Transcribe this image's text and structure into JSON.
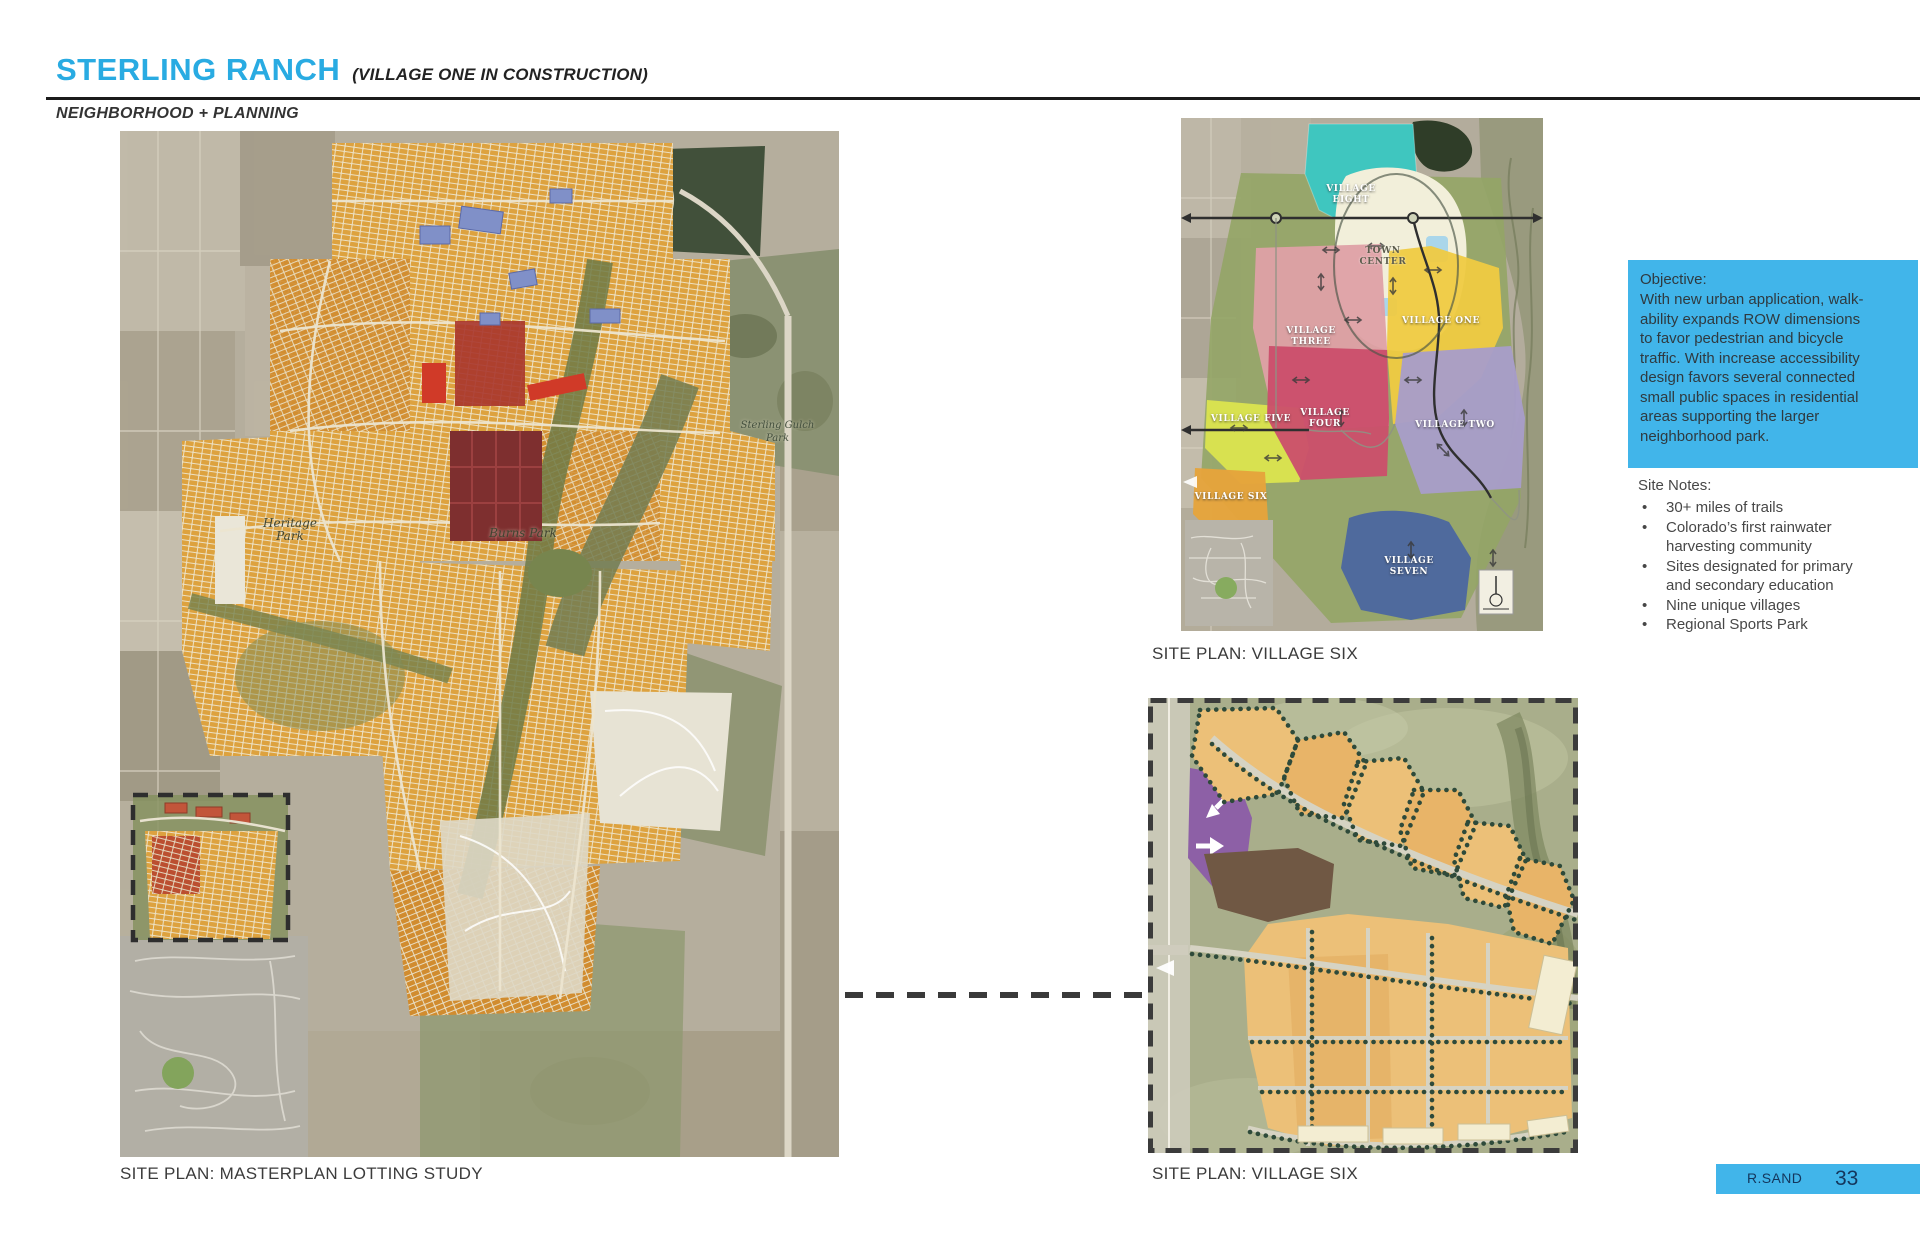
{
  "header": {
    "title": "STERLING RANCH",
    "subtitle": "(VILLAGE ONE IN CONSTRUCTION)",
    "category": "NEIGHBORHOOD + PLANNING"
  },
  "main_map": {
    "caption": "SITE PLAN: MASTERPLAN LOTTING STUDY",
    "labels": {
      "park1": "Heritage Park",
      "park2": "Burns Park",
      "park3": "Sterling Gulch Park"
    }
  },
  "village_map": {
    "caption": "SITE PLAN: VILLAGE SIX",
    "villages": [
      {
        "name": "VILLAGE EIGHT",
        "color": "#3fc6bf"
      },
      {
        "name": "TOWN CENTER",
        "color": "#f2efda"
      },
      {
        "name": "VILLAGE THREE",
        "color": "#dea0a6"
      },
      {
        "name": "VILLAGE ONE",
        "color": "#efca42"
      },
      {
        "name": "VILLAGE FOUR",
        "color": "#cb4e6b"
      },
      {
        "name": "VILLAGE TWO",
        "color": "#a89dca"
      },
      {
        "name": "VILLAGE FIVE",
        "color": "#dbe44f"
      },
      {
        "name": "VILLAGE SIX",
        "color": "#e5a43c"
      },
      {
        "name": "VILLAGE SEVEN",
        "color": "#4b66a0"
      }
    ]
  },
  "detail_plan": {
    "caption": "SITE PLAN: VILLAGE SIX"
  },
  "objective_box": {
    "heading": "Objective:",
    "body": "With new urban application, walk-ability expands ROW dimensions to favor pedestrian and bicycle traffic.  With increase accessibility design favors several connected small public spaces in residential areas supporting the larger neighborhood park."
  },
  "site_notes": {
    "heading": "Site Notes:",
    "items": [
      "30+ miles of trails",
      "Colorado’s first rainwater harvesting community",
      "Sites designated for primary and secondary education",
      "Nine unique villages",
      "Regional Sports Park"
    ]
  },
  "footer": {
    "author": "R.SAND",
    "page_number": "33"
  },
  "colors": {
    "accent_blue": "#29abe2",
    "panel_blue": "#41b5ea",
    "footer_text": "#14365c"
  }
}
